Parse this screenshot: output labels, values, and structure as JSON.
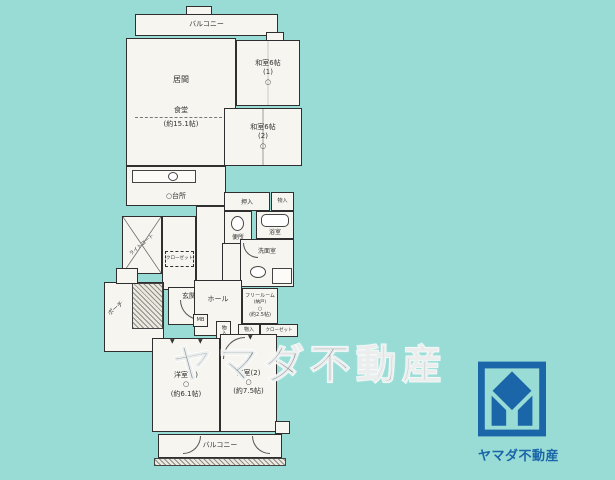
{
  "colors": {
    "background": "#99dcd6",
    "paper": "#f6f5f0",
    "wall_line": "#2f2f2f",
    "logo_blue": "#1a66a8",
    "watermark_gray": "#7e8c8e"
  },
  "watermark": "ヤマダ不動産",
  "logo": {
    "brand": "ヤマダ不動産"
  },
  "fp": {
    "balcony_top": "バルコニー",
    "balcony_bottom": "バルコニー",
    "living": {
      "name": "居間",
      "dining": "食堂",
      "size": "(約15.1帖)"
    },
    "washitsu1": {
      "name": "和室6帖",
      "num": "(1)",
      "mark": "○"
    },
    "washitsu2": {
      "name": "和室6帖",
      "num": "(2)",
      "mark": "○"
    },
    "kitchen": {
      "mark": "○",
      "name": "台所"
    },
    "oshiire": "押入",
    "storage_top": "物入",
    "toilet": "便所",
    "bath": "浴室",
    "washroom": "洗面室",
    "light_court": "ライトコート",
    "closet_mid": "クローゼット",
    "porch": "ポーチ",
    "entrance": "玄関",
    "hall": "ホール",
    "mb": "MB",
    "storage_hall": "物入",
    "free_room": {
      "name": "フリールーム",
      "sub": "(納戸)",
      "mark": "○",
      "size": "(約2.5帖)"
    },
    "storage2": "物入",
    "closet_low": "クローゼット",
    "bedroom1": {
      "name": "洋室(1)",
      "mark": "○",
      "size": "(約6.1帖)"
    },
    "bedroom2": {
      "name": "洋室(2)",
      "mark": "○",
      "size": "(約7.5帖)"
    }
  }
}
